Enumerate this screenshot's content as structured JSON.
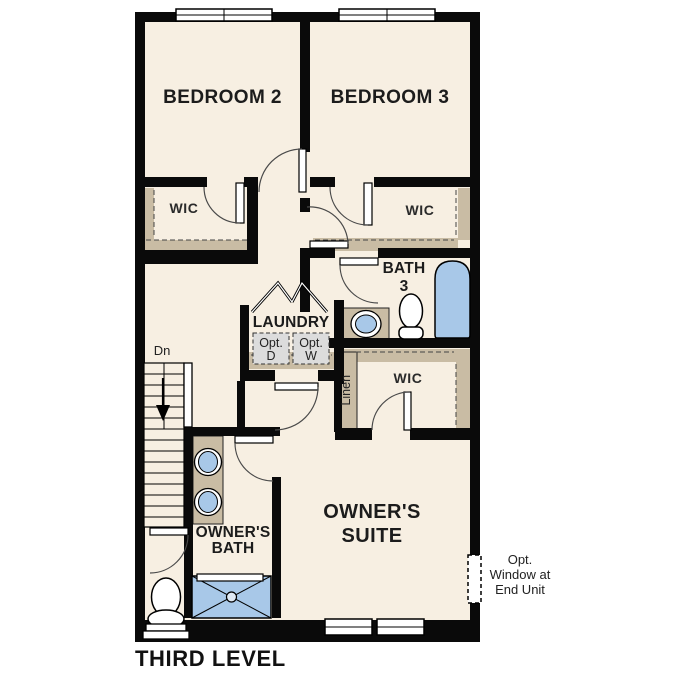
{
  "title": "THIRD LEVEL",
  "colors": {
    "floor": "#f7efe2",
    "wall": "#0a0a0a",
    "closet_shelf_tan": "#c9bca4",
    "fixture_blue": "#a8c8e8",
    "optional_appliance_gray": "#dcdcdc"
  },
  "rooms": {
    "bedroom2": {
      "label": "BEDROOM 2"
    },
    "bedroom3": {
      "label": "BEDROOM 3"
    },
    "wic_left": {
      "label": "WIC"
    },
    "wic_right": {
      "label": "WIC"
    },
    "wic_owners": {
      "label": "WIC"
    },
    "bath3": {
      "line1": "BATH",
      "line2": "3"
    },
    "laundry": {
      "label": "LAUNDRY",
      "opt_dryer": {
        "line1": "Opt.",
        "line2": "D"
      },
      "opt_washer": {
        "line1": "Opt.",
        "line2": "W"
      }
    },
    "linen": {
      "label": "Linen"
    },
    "stairs": {
      "label": "Dn"
    },
    "owners_bath": {
      "line1": "OWNER'S",
      "line2": "BATH"
    },
    "owners_suite": {
      "line1": "OWNER'S",
      "line2": "SUITE"
    }
  },
  "annotations": {
    "opt_window": {
      "line1": "Opt.",
      "line2": "Window at",
      "line3": "End Unit"
    }
  }
}
